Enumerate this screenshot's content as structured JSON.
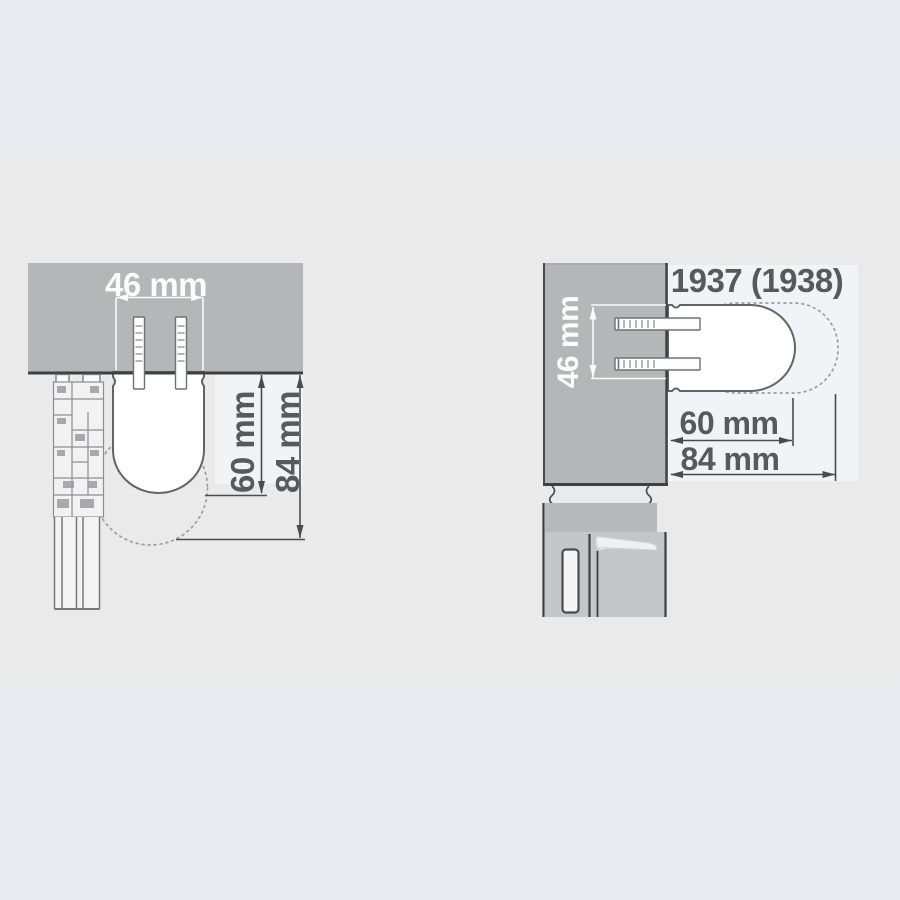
{
  "drawing": {
    "description_colors": {
      "background_band": "#e8ecf0",
      "canvas": "#eaeaeb",
      "highlight_patch": "#f1f4f6",
      "mounting_panel_gray": "#b5b6b7",
      "dark_line": "#3f4042",
      "dimension_line": "#4a4b4d",
      "handle_outline": "#636466",
      "dashed_swing": "#9b9c9e",
      "dimension_text": "#58595b",
      "white_text": "#fcfcfc"
    },
    "left_view": {
      "spacing_label": "46 mm",
      "projection_label": "60 mm",
      "swing_label": "84 mm"
    },
    "right_view": {
      "model_label": "1937 (1938)",
      "spacing_label": "46 mm",
      "projection_label": "60 mm",
      "swing_label": "84 mm"
    }
  }
}
